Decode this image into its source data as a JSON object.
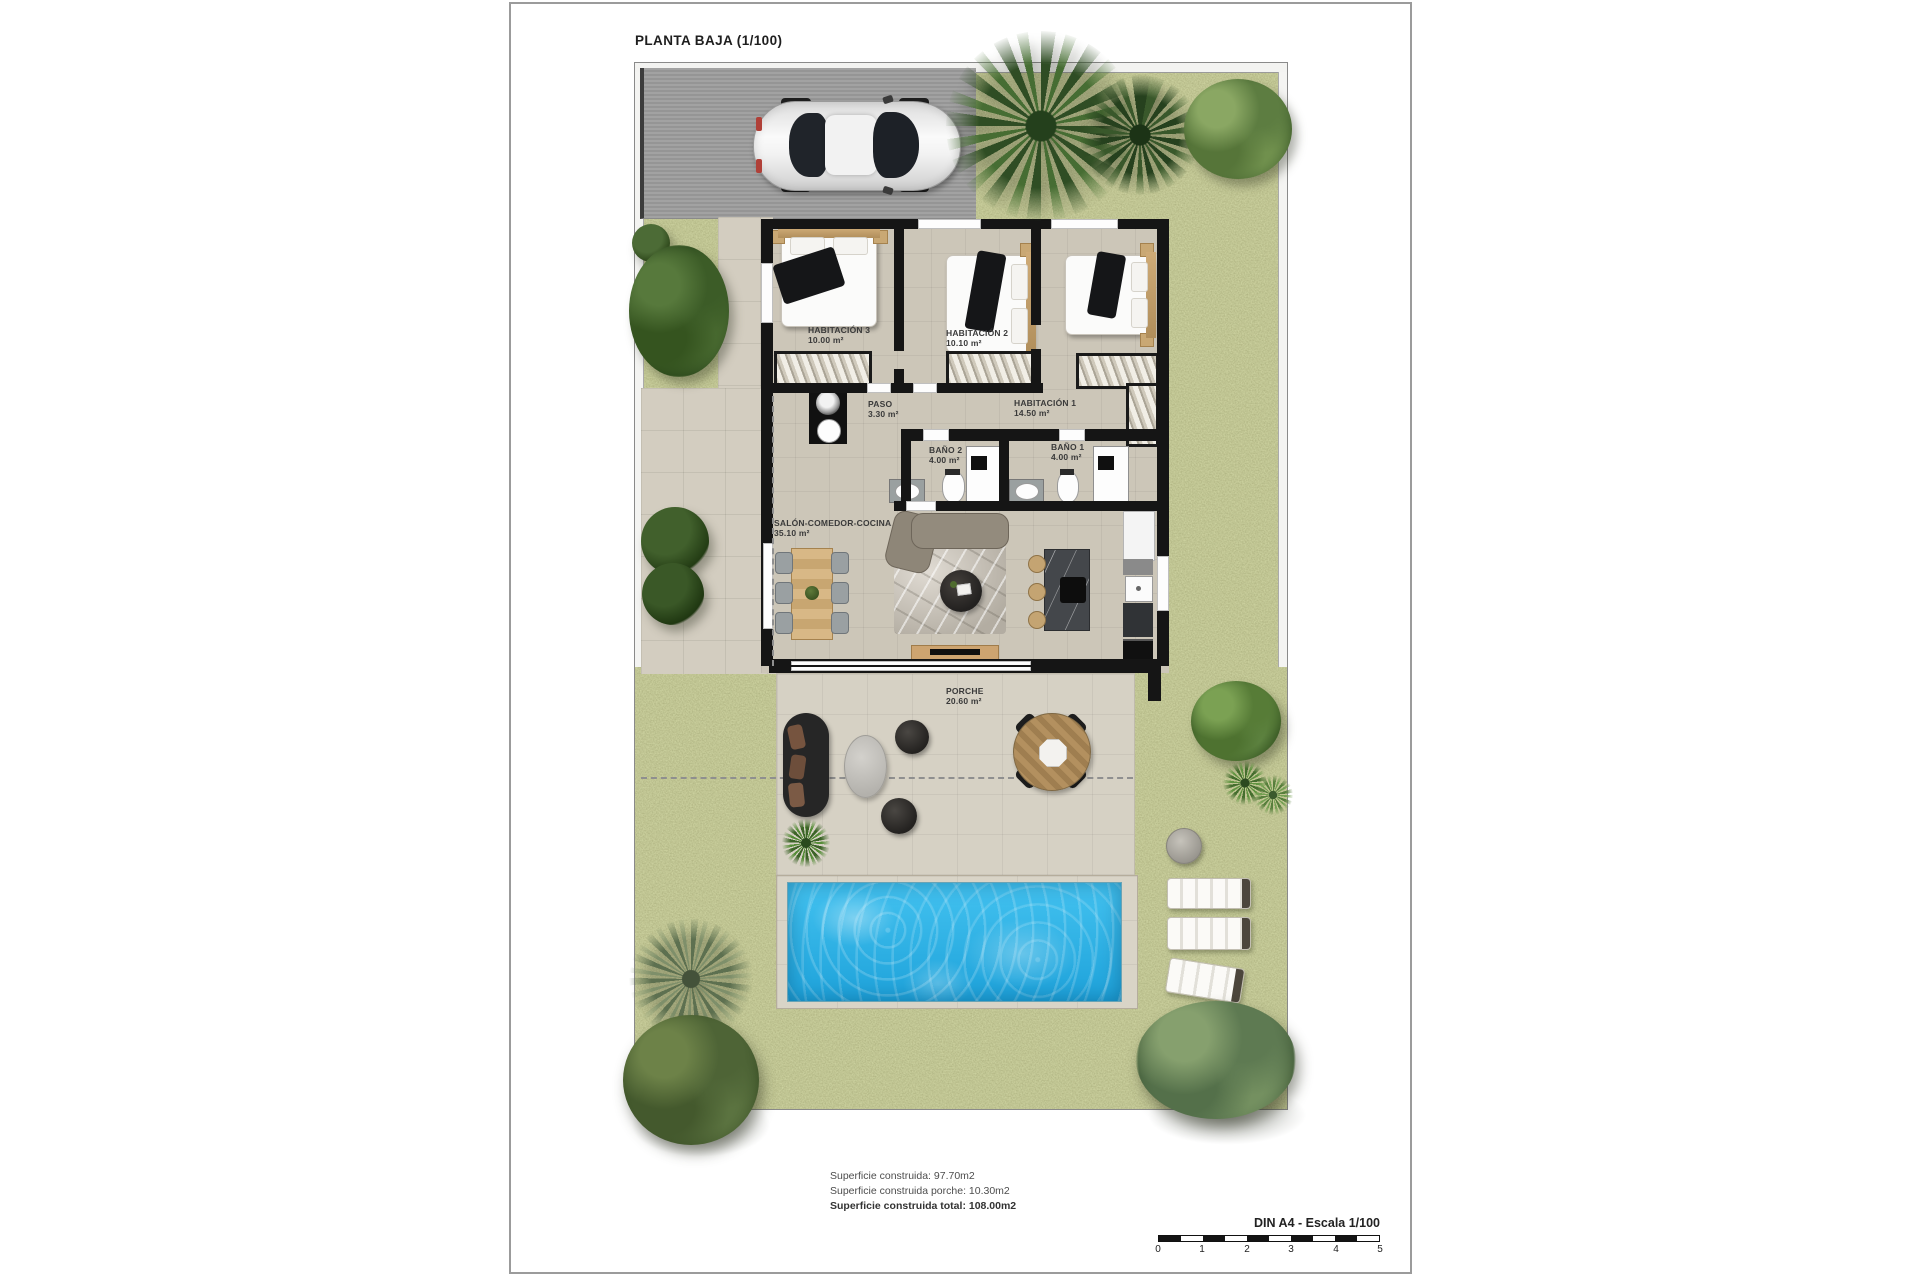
{
  "page": {
    "title": "PLANTA BAJA (1/100)",
    "rooms": {
      "hab3": {
        "name": "HABITACIÓN 3",
        "area": "10.00 m²"
      },
      "hab2": {
        "name": "HABITACIÓN 2",
        "area": "10.10 m²"
      },
      "hab1": {
        "name": "HABITACIÓN 1",
        "area": "14.50 m²"
      },
      "paso": {
        "name": "PASO",
        "area": "3.30 m²"
      },
      "bano2": {
        "name": "BAÑO 2",
        "area": "4.00 m²"
      },
      "bano1": {
        "name": "BAÑO 1",
        "area": "4.00 m²"
      },
      "salon": {
        "name": "SALÓN-COMEDOR-COCINA",
        "area": "35.10 m²"
      },
      "porche": {
        "name": "PORCHE",
        "area": "20.60 m²"
      }
    },
    "summary": {
      "line1": "Superficie construida: 97.70m2",
      "line2": "Superficie construida porche: 10.30m2",
      "line3": "Superficie construida total: 108.00m2"
    },
    "scalebar": {
      "label": "DIN A4 - Escala 1/100",
      "ticks": [
        "0",
        "1",
        "2",
        "3",
        "4",
        "5"
      ]
    },
    "colors": {
      "grass": "#8d9156",
      "pool_water": "#29b1e6",
      "wall": "#151515",
      "floor": "#ccc6b8",
      "driveway": "#9d9d9d",
      "deck": "#d9d4c7"
    }
  }
}
